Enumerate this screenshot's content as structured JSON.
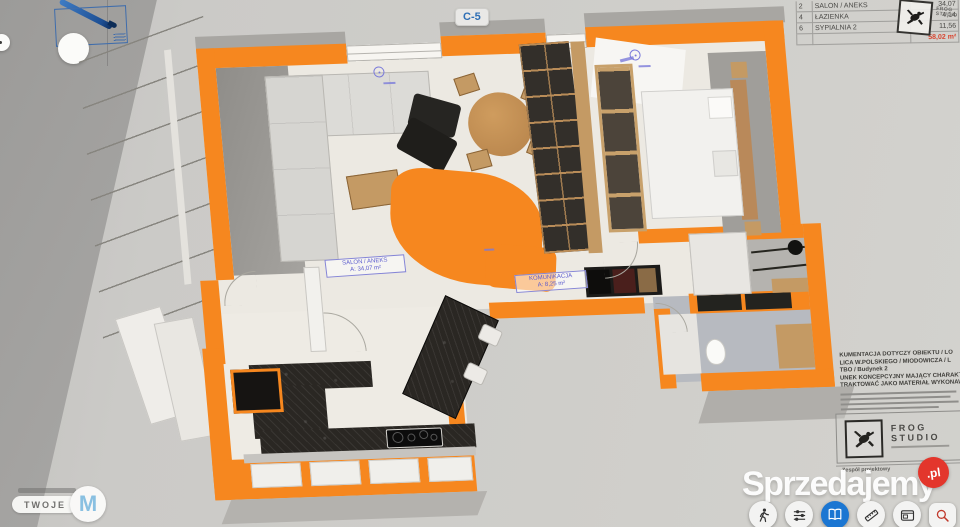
{
  "badge": {
    "label": "C-5"
  },
  "area_table": {
    "rows": [
      {
        "no": "2",
        "name": "SALON / ANEKS",
        "area": "34,07"
      },
      {
        "no": "4",
        "name": "ŁAZIENKA",
        "area": "4,14"
      },
      {
        "no": "6",
        "name": "SYPIALNIA 2",
        "area": "11,56"
      }
    ],
    "total": "58,02 m²"
  },
  "stamp": {
    "line1": "FROG",
    "line2": "STUDIO"
  },
  "room_labels": {
    "salon": {
      "name": "SALON / ANEKS",
      "area": "A: 34,07 m²"
    },
    "komunikacja": {
      "name": "KOMUNIKACJA",
      "area": "A: 8,25 m²"
    }
  },
  "notes": {
    "line1": "KUMENTACJA DOTYCZY OBIEKTU / LO",
    "line2": "LICA W.POLSKIEGO / MIODOWICZA / L",
    "line3": "TBO / Budynek 2",
    "line4": "UNEK KONCEPCYJNY MAJĄCY CHARAKT",
    "line5": "TRAKTOWAĆ JAKO MATERIAŁ WYKONAW"
  },
  "title_block": {
    "studio_line1": "FROG",
    "studio_line2": "STUDIO",
    "team_label": "Zespół projektowy"
  },
  "watermark": {
    "text": "Sprzedajemy",
    "suffix": ".pl"
  },
  "agency_logo": {
    "text": "TWOJE",
    "initial": "M"
  },
  "toolbar": {
    "items": [
      "walk-mode",
      "display-settings",
      "catalog",
      "measure",
      "floorplan-card",
      "zoom-search"
    ],
    "active": "catalog"
  },
  "colors": {
    "wall_orange": "#f6871f",
    "total_red": "#d8442f",
    "annotation_blue": "#7a7ada",
    "toolbar_active_blue": "#1b76d2",
    "watermark_red": "#e3362c",
    "agency_blue": "#84c0e4"
  }
}
